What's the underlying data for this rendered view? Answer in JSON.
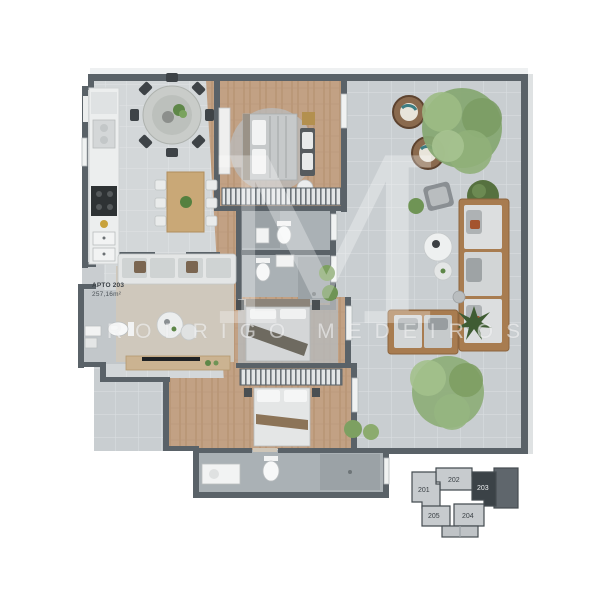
{
  "plan": {
    "unit_label_line1": "APTO 203",
    "unit_label_line2": "257,16m²",
    "watermark_name": "RODRIGO MEDEIROS",
    "watermark_monogram": "M",
    "colors": {
      "wall": "#5a6268",
      "terrace_floor": "#c9ced1",
      "indoor_floor": "#d3d7d9",
      "wood_floor": "#c2a184",
      "bath_floor": "#aab1b5",
      "keyplan_highlight": "#3b4247"
    }
  },
  "keyplan": {
    "units": [
      {
        "id": "201",
        "highlighted": false
      },
      {
        "id": "202",
        "highlighted": false
      },
      {
        "id": "203",
        "highlighted": true
      },
      {
        "id": "204",
        "highlighted": false
      },
      {
        "id": "205",
        "highlighted": false
      }
    ]
  }
}
